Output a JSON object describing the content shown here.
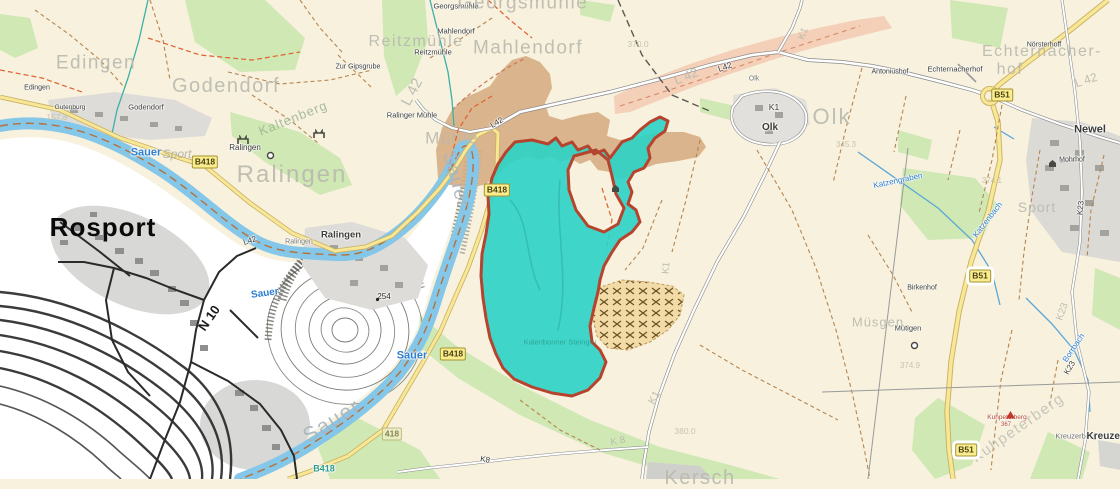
{
  "map": {
    "background_color": "#f7f1de",
    "luxembourg_bg_color": "#ffffff",
    "water_color": "#85c7e8",
    "forest_color": "#cfe8b4",
    "quarry_area_color": "#d6ad83",
    "highlight_area": {
      "fill": "#2fd3c6",
      "border": "#b5442e"
    },
    "labels": [
      {
        "t": "Edingen",
        "x": 37,
        "y": 88,
        "s": 7,
        "h": 1
      },
      {
        "t": "Gutenburg",
        "x": 70,
        "y": 108,
        "s": 6.5,
        "h": 1
      },
      {
        "t": "Godendorf",
        "x": 146,
        "y": 107,
        "s": 7.5,
        "h": 1
      },
      {
        "t": "Zur Gipsgrube",
        "x": 358,
        "y": 67,
        "s": 7,
        "h": 1
      },
      {
        "t": "Georgsmühle",
        "x": 456,
        "y": 6,
        "s": 7.5,
        "h": 1
      },
      {
        "t": "Mahlendorf",
        "x": 456,
        "y": 31,
        "s": 7.5,
        "h": 1
      },
      {
        "t": "Reitzmühle",
        "x": 433,
        "y": 52,
        "s": 7.5,
        "h": 1
      },
      {
        "t": "Ralinger Mühle",
        "x": 412,
        "y": 115,
        "s": 7.5,
        "h": 1
      },
      {
        "t": "Ralingen",
        "x": 245,
        "y": 148,
        "s": 8,
        "h": 1
      },
      {
        "t": "Ralingen",
        "x": 299,
        "y": 242,
        "s": 7,
        "c": "#787872",
        "h": 1
      },
      {
        "t": "Ralingen",
        "x": 341,
        "y": 235,
        "s": 9.5,
        "b": 1,
        "h": 1
      },
      {
        "t": "Olk",
        "x": 754,
        "y": 79,
        "s": 7,
        "c": "#787872",
        "h": 1
      },
      {
        "t": "Olk",
        "x": 770,
        "y": 128,
        "s": 10,
        "b": 1,
        "h": 1
      },
      {
        "t": "Antoniushof",
        "x": 890,
        "y": 72,
        "s": 7,
        "h": 1
      },
      {
        "t": "Echternacherhof",
        "x": 955,
        "y": 69,
        "s": 7.5,
        "h": 1
      },
      {
        "t": "Nörsterhoff",
        "x": 1044,
        "y": 45,
        "s": 7,
        "h": 1
      },
      {
        "t": "Newel",
        "x": 1090,
        "y": 130,
        "s": 11,
        "b": 1,
        "h": 1
      },
      {
        "t": "Mohrhof",
        "x": 1072,
        "y": 160,
        "s": 7,
        "h": 1
      },
      {
        "t": "Birkenhof",
        "x": 922,
        "y": 288,
        "s": 7,
        "h": 1
      },
      {
        "t": "Mütigen",
        "x": 908,
        "y": 328,
        "s": 7.5,
        "h": 1
      },
      {
        "t": "Kreuzerberg",
        "x": 1076,
        "y": 436,
        "s": 7.5,
        "c": "#6e6e68",
        "h": 1
      },
      {
        "t": "Kreuzerberg",
        "x": 1116,
        "y": 437,
        "s": 10,
        "b": 1,
        "h": 1
      },
      {
        "t": "Kuhpeterberg",
        "x": 1007,
        "y": 418,
        "s": 6.5,
        "c": "#b5442e",
        "h": 1
      },
      {
        "t": "367",
        "x": 1006,
        "y": 425,
        "s": 6,
        "c": "#b5442e",
        "h": 1
      },
      {
        "t": "254",
        "x": 384,
        "y": 297,
        "s": 8,
        "c": "#2a2a2a",
        "h": 1
      },
      {
        "t": "N 10",
        "x": 209,
        "y": 318,
        "s": 13,
        "b": 1,
        "r": -55,
        "c": "#1a1a1a"
      },
      {
        "t": "Rosport",
        "x": 103,
        "y": 227,
        "s": 26,
        "b": 1,
        "c": "#0a0a0a",
        "ls": 1
      },
      {
        "t": "K8",
        "x": 485,
        "y": 460,
        "s": 8,
        "r": 10,
        "h": 1
      },
      {
        "t": "K23",
        "x": 1081,
        "y": 208,
        "s": 8,
        "r": -85,
        "h": 1
      },
      {
        "t": "K23",
        "x": 1070,
        "y": 368,
        "s": 8,
        "r": -60,
        "h": 1
      },
      {
        "t": "L42",
        "x": 497,
        "y": 123,
        "s": 8,
        "r": -30,
        "h": 1
      },
      {
        "t": "L42",
        "x": 250,
        "y": 241,
        "s": 8,
        "r": -18,
        "h": 1
      },
      {
        "t": "L42",
        "x": 725,
        "y": 67,
        "s": 8.5,
        "r": -20,
        "h": 1
      },
      {
        "t": "K1",
        "x": 774,
        "y": 107,
        "s": 8.5,
        "h": 1
      },
      {
        "t": "Sauer",
        "x": 146,
        "y": 153,
        "s": 11,
        "b": 1,
        "c": "#2f7fd0",
        "h": 1
      },
      {
        "t": "Sauer",
        "x": 265,
        "y": 294,
        "s": 10,
        "r": -8,
        "b": 1,
        "c": "#2f7fd0",
        "h": 1
      },
      {
        "t": "Sauer",
        "x": 412,
        "y": 356,
        "s": 11,
        "b": 1,
        "c": "#2f7fd0",
        "h": 1
      },
      {
        "t": "B418",
        "x": 324,
        "y": 469,
        "s": 9,
        "b": 1,
        "c": "#2a9d8f",
        "h": 1
      },
      {
        "t": "Katzenbach",
        "x": 988,
        "y": 220,
        "s": 8,
        "r": -52,
        "c": "#2f7fd0",
        "h": 1
      },
      {
        "t": "Borrbach",
        "x": 1074,
        "y": 348,
        "s": 8,
        "r": -56,
        "c": "#2f7fd0",
        "h": 1
      },
      {
        "t": "Katzengraben",
        "x": 898,
        "y": 181,
        "s": 8,
        "r": -12,
        "c": "#2f7fd0",
        "h": 1
      },
      {
        "t": "Kalenbonner Steingru",
        "x": 560,
        "y": 342,
        "s": 7.5,
        "c": "#1f8078",
        "o": 0.55
      },
      {
        "t": "Edingen",
        "x": 96,
        "y": 63,
        "s": 19,
        "c": "#b9b9ae",
        "ls": 1.5,
        "f": 1
      },
      {
        "t": "Godendorf",
        "x": 226,
        "y": 86,
        "s": 20,
        "c": "#b9b9ae",
        "ls": 1.5,
        "f": 1
      },
      {
        "t": "Georgsmühle",
        "x": 523,
        "y": 3,
        "s": 19,
        "c": "#b9b9ae",
        "ls": 1.5,
        "f": 1
      },
      {
        "t": "Mahlendorf",
        "x": 528,
        "y": 48,
        "s": 19,
        "c": "#b9b9ae",
        "ls": 1.5,
        "f": 1
      },
      {
        "t": "Reitzmühle",
        "x": 416,
        "y": 42,
        "s": 16,
        "c": "#b9b9ae",
        "ls": 1.5,
        "f": 1
      },
      {
        "t": "Mühle",
        "x": 452,
        "y": 138,
        "s": 17,
        "c": "#b9b9ae",
        "ls": 1.5,
        "f": 1
      },
      {
        "t": "Ralingen",
        "x": 292,
        "y": 175,
        "s": 24,
        "c": "#b9b9ae",
        "ls": 2,
        "f": 1
      },
      {
        "t": "Olk",
        "x": 832,
        "y": 117,
        "s": 22,
        "c": "#b9b9ae",
        "ls": 2,
        "f": 1
      },
      {
        "t": "Echternacher-",
        "x": 1042,
        "y": 52,
        "s": 16,
        "c": "#b9b9ae",
        "ls": 1.5,
        "f": 1
      },
      {
        "t": "hof",
        "x": 1010,
        "y": 70,
        "s": 16,
        "c": "#b9b9ae",
        "ls": 1.5,
        "f": 1
      },
      {
        "t": "Müsgen",
        "x": 878,
        "y": 322,
        "s": 13,
        "c": "#b9b9ae",
        "ls": 1,
        "f": 1
      },
      {
        "t": "Kersch",
        "x": 700,
        "y": 478,
        "s": 20,
        "c": "#b9b9ae",
        "ls": 1.5,
        "f": 1
      },
      {
        "t": "Kuhpeterberg",
        "x": 1018,
        "y": 428,
        "s": 15,
        "r": -35,
        "c": "#c2c2b6",
        "ls": 1.5,
        "f": 1
      },
      {
        "t": "Kaltenberg",
        "x": 293,
        "y": 118,
        "s": 13,
        "r": -22,
        "c": "#9fb694",
        "ls": 1,
        "f": 1
      },
      {
        "t": "Sport",
        "x": 177,
        "y": 154,
        "s": 12,
        "i": 1,
        "c": "#b0b0a6",
        "f": 1
      },
      {
        "t": "Sport",
        "x": 1037,
        "y": 207,
        "s": 14,
        "c": "#b9b9ae",
        "ls": 1,
        "f": 1
      },
      {
        "t": "Sauer",
        "x": 456,
        "y": 180,
        "s": 19,
        "r": 75,
        "c": "#a9b4bd",
        "ls": 1.5,
        "f": 1
      },
      {
        "t": "Sauer",
        "x": 332,
        "y": 421,
        "s": 21,
        "r": -32,
        "c": "#a9b4bd",
        "ls": 1.5,
        "f": 1
      },
      {
        "t": "L 42",
        "x": 412,
        "y": 92,
        "s": 15,
        "r": -62,
        "c": "#b9b9ae",
        "f": 1
      },
      {
        "t": "L 42",
        "x": 686,
        "y": 76,
        "s": 13,
        "r": -22,
        "c": "#b9b9ae",
        "f": 1
      },
      {
        "t": "L 42",
        "x": 1086,
        "y": 80,
        "s": 12,
        "r": -18,
        "c": "#b9b9ae",
        "f": 1
      },
      {
        "t": "K1",
        "x": 804,
        "y": 34,
        "s": 10,
        "r": -68,
        "c": "#b9b9ae",
        "f": 1
      },
      {
        "t": "K1",
        "x": 667,
        "y": 268,
        "s": 10,
        "r": -85,
        "c": "#b9b9ae",
        "f": 1
      },
      {
        "t": "K1",
        "x": 655,
        "y": 398,
        "s": 11,
        "r": -60,
        "c": "#b9b9ae",
        "f": 1
      },
      {
        "t": "K 8",
        "x": 618,
        "y": 442,
        "s": 10,
        "r": -10,
        "c": "#b9b9ae",
        "f": 1
      },
      {
        "t": "K23",
        "x": 1063,
        "y": 312,
        "s": 10,
        "r": -70,
        "c": "#b9b9ae",
        "f": 1
      },
      {
        "t": "370.0",
        "x": 638,
        "y": 44,
        "s": 8.5,
        "c": "#c2bfa8",
        "f": 1
      },
      {
        "t": "157.8",
        "x": 57,
        "y": 117,
        "s": 8.5,
        "c": "#c2bfa8",
        "f": 1
      },
      {
        "t": "345.3",
        "x": 846,
        "y": 145,
        "s": 8,
        "c": "#c2bfa8",
        "f": 1
      },
      {
        "t": "374.1",
        "x": 992,
        "y": 181,
        "s": 8,
        "c": "#c2bfa8",
        "f": 1
      },
      {
        "t": "374.9",
        "x": 910,
        "y": 366,
        "s": 8,
        "c": "#c2bfa8",
        "f": 1
      },
      {
        "t": "380.0",
        "x": 685,
        "y": 431,
        "s": 8.5,
        "c": "#c2bfa8",
        "f": 1
      }
    ],
    "badges": [
      {
        "t": "B418",
        "x": 205,
        "y": 162
      },
      {
        "t": "B418",
        "x": 497,
        "y": 190
      },
      {
        "t": "B418",
        "x": 453,
        "y": 354
      },
      {
        "t": "418",
        "x": 392,
        "y": 434,
        "v": "faded"
      },
      {
        "t": "B51",
        "x": 1002,
        "y": 95
      },
      {
        "t": "B51",
        "x": 980,
        "y": 276,
        "v": "boxed"
      },
      {
        "t": "B51",
        "x": 966,
        "y": 450,
        "v": "boxed"
      }
    ],
    "icons": [
      {
        "k": "ruin",
        "x": 237,
        "y": 135
      },
      {
        "k": "ruin",
        "x": 313,
        "y": 129
      },
      {
        "k": "house",
        "x": 1048,
        "y": 159
      },
      {
        "k": "house",
        "x": 611,
        "y": 184
      },
      {
        "k": "triangle",
        "x": 1006,
        "y": 411
      },
      {
        "k": "circle",
        "x": 266,
        "y": 151
      },
      {
        "k": "circle",
        "x": 910,
        "y": 341
      },
      {
        "k": "dot",
        "x": 375,
        "y": 297
      }
    ]
  }
}
